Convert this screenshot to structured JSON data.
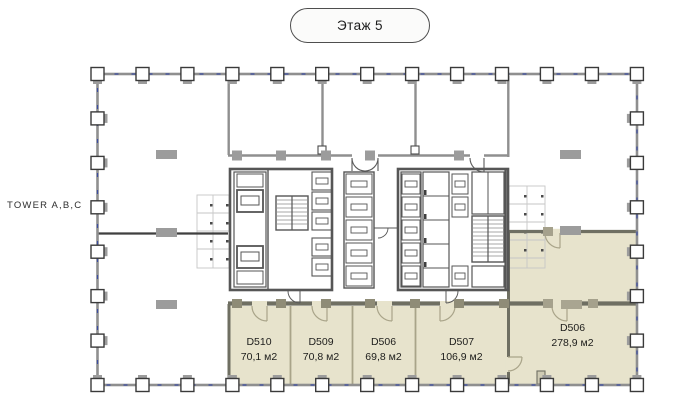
{
  "floor_selector": {
    "label": "Этаж 5"
  },
  "tower_label": "TOWER A,B,C",
  "rooms": [
    {
      "id": "D510",
      "area": "70,1 м2"
    },
    {
      "id": "D509",
      "area": "70,8 м2"
    },
    {
      "id": "D506",
      "area": "69,8 м2"
    },
    {
      "id": "D507",
      "area": "106,9 м2"
    },
    {
      "id": "D506",
      "area": "278,9 м2"
    }
  ],
  "colors": {
    "room_highlight": "#e7e3cc",
    "room_divider": "#a9a489",
    "room_wall": "#6f6f62",
    "plan_wall": "#8f8f8f",
    "core_wall": "#565656",
    "perimeter_dash": "#3c4da0"
  }
}
